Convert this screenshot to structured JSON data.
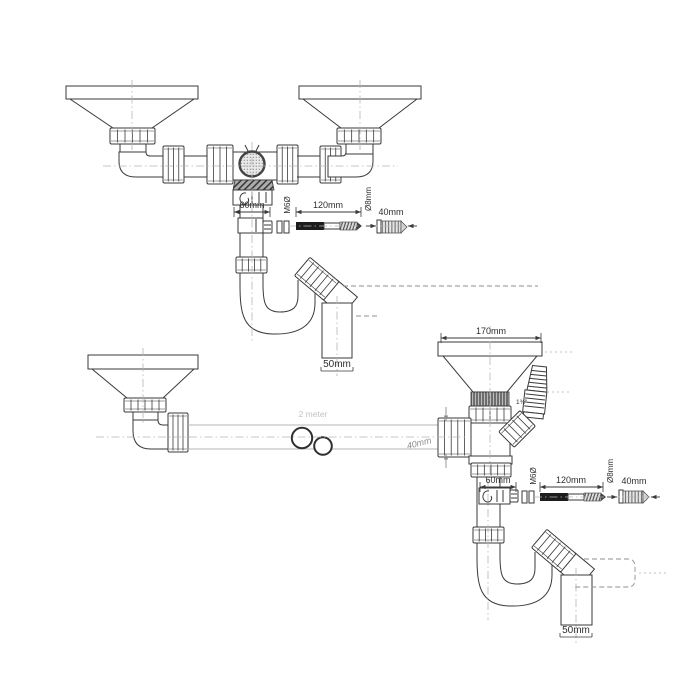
{
  "page": {
    "background": "#ffffff",
    "line_color": "#3a3a3a"
  },
  "diagram1": {
    "name": "double-bowl-drain-kit",
    "labels": {
      "bracket_width": "60mm",
      "screw_thread": "M6Ø",
      "screw_length": "120mm",
      "plug_diameter": "Ø8mm",
      "plug_length": "40mm",
      "outlet_diameter": "50mm"
    }
  },
  "diagram2": {
    "name": "single-drain-with-overflow-kit",
    "labels": {
      "funnel_width": "170mm",
      "thread_size": "1¾\"",
      "pipe_length": "2 meter",
      "pipe_diameter": "40mm",
      "bracket_width": "60mm",
      "screw_thread": "M6Ø",
      "screw_length": "120mm",
      "plug_diameter": "Ø8mm",
      "plug_length": "40mm",
      "outlet_diameter": "50mm"
    }
  }
}
